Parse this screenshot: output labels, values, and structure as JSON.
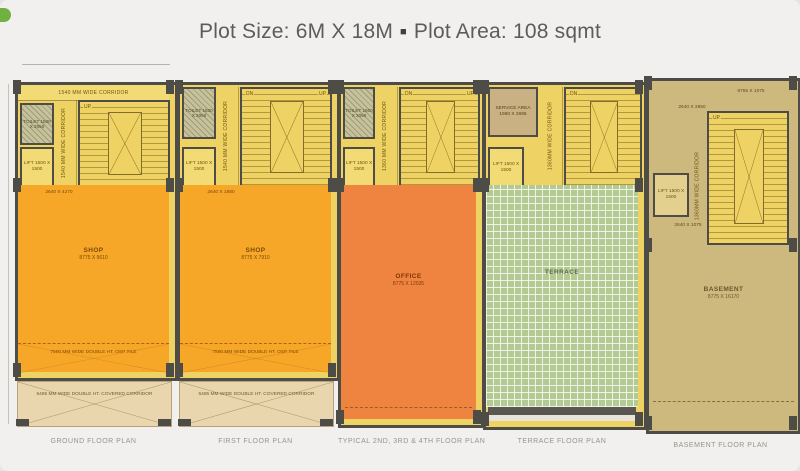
{
  "header": {
    "plot_size_label": "Plot Size: 6M X 18M",
    "separator": "■",
    "plot_area_label": "Plot Area: 108 sqmt"
  },
  "plans": [
    {
      "caption": "GROUND FLOOR PLAN",
      "top_corridor": "1540 MM WIDE CORRIDOR",
      "toilet": "TOILET 1500 X 2050",
      "lift": "LIFT 1500 X 1500",
      "side_corridor": "1540 MM WIDE CORRIDOR",
      "stair_up": "UP",
      "zone_dim": "2640 X 4270",
      "room": "SHOP",
      "room_dim": "8775 X 9610",
      "double_ht_note": "7500 MM WIDE DOUBLE HT. OSP TILE",
      "covered_corridor_note": "5485 MM WIDE DOUBLE HT. COVERED CORRIDOR"
    },
    {
      "caption": "FIRST FLOOR PLAN",
      "toilet": "TOILET 1500 X 2050",
      "lift": "LIFT 1500 X 1500",
      "side_corridor": "1540 MM WIDE CORRIDOR",
      "stair_up": "UP",
      "stair_dn": "DN",
      "zone_dim": "2640 X 1880",
      "room": "SHOP",
      "room_dim": "8775 X 7910",
      "double_ht_note": "7500 MM WIDE DOUBLE HT. OSP TILE",
      "covered_corridor_note": "5485 MM WIDE DOUBLE HT. COVERED CORRIDOR"
    },
    {
      "caption": "TYPICAL 2ND, 3RD & 4TH FLOOR PLAN",
      "toilet": "TOILET 1500 X 2050",
      "lift": "LIFT 1500 X 1500",
      "side_corridor": "1360 MM WIDE CORRIDOR",
      "stair_up": "UP",
      "stair_dn": "DN",
      "room": "OFFICE",
      "room_dim": "8775 X 12035"
    },
    {
      "caption": "TERRACE FLOOR PLAN",
      "service_area": "SERVICE AREA 1960 X 2695",
      "lift": "LIFT 1500 X 1500",
      "side_corridor": "1360MM WIDE CORRIDOR",
      "stair_dn": "DN",
      "room": "TERRACE"
    },
    {
      "caption": "BASEMENT FLOOR PLAN",
      "dim_top_right": "9755 X 1075",
      "dim_top_left": "2640 X 2850",
      "lift": "LIFT 1500 X 1500",
      "side_corridor": "1360MM WIDE CORRIDOR",
      "stair_up": "UP",
      "dim_below_lift": "2640 X 1075",
      "room": "BASEMENT",
      "room_dim": "8775 X 16170"
    }
  ],
  "colors": {
    "background": "#f1f0ee",
    "yellow": "#eed263",
    "shop_orange": "#f7a727",
    "office_orange": "#ef8440",
    "terrace_green": "#b3cb93",
    "basement_tan": "#cdb87e",
    "wall": "#4e4c47"
  }
}
